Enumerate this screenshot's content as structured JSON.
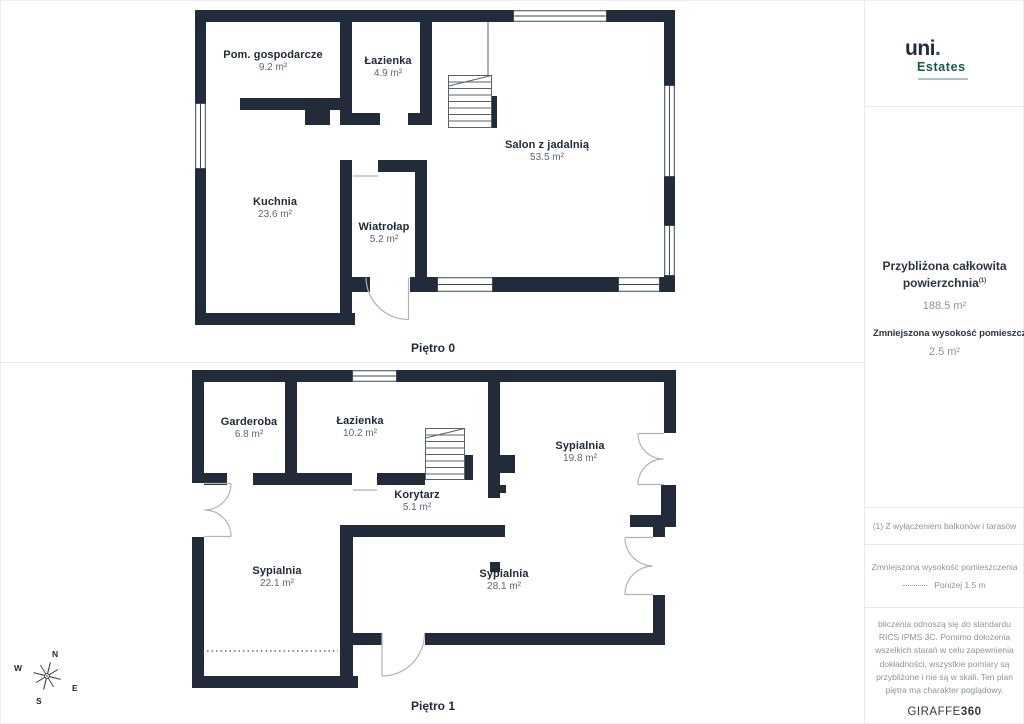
{
  "brand_logo": {
    "name": "uni",
    "dot": ".",
    "subtitle": "Estates"
  },
  "sidebar": {
    "total_area_label": "Przybliżona całkowita powierzchnia",
    "total_area_sup": "(1)",
    "total_area_value": "188.5 m²",
    "reduced_height_label": "Zmniejszona wysokość pomieszczenia",
    "reduced_height_value": "2.5 m²",
    "footnote": "(1) Z wyłączeniem balkonów i tarasów",
    "legend_title": "Zmniejszona wysokość pomieszczenia",
    "legend_item": "Poniżej 1.5 m",
    "disclaimer": "bliczenia odnoszą się do standardu RICS IPMS 3C. Pomimo dołożenia wszelkich starań w celu zapewnienia dokładności, wszystkie pomiary są przybliżone i nie są w skali. Ten plan piętra ma charakter poglądowy.",
    "watermark_regular": "GIRAFFE",
    "watermark_bold": "360"
  },
  "floors": [
    {
      "caption": "Piętro 0",
      "rooms": [
        {
          "name": "Pom. gospodarcze",
          "area": "9.2 m²"
        },
        {
          "name": "Łazienka",
          "area": "4.9 m²"
        },
        {
          "name": "Salon z jadalnią",
          "area": "53.5 m²"
        },
        {
          "name": "Kuchnia",
          "area": "23.6 m²"
        },
        {
          "name": "Wiatrołap",
          "area": "5.2 m²"
        }
      ]
    },
    {
      "caption": "Piętro 1",
      "rooms": [
        {
          "name": "Garderoba",
          "area": "6.8 m²"
        },
        {
          "name": "Łazienka",
          "area": "10.2 m²"
        },
        {
          "name": "Sypialnia",
          "area": "19.8 m²"
        },
        {
          "name": "Korytarz",
          "area": "5.1 m²"
        },
        {
          "name": "Sypialnia",
          "area": "22.1 m²"
        },
        {
          "name": "Sypialnia",
          "area": "28.1 m²"
        }
      ]
    }
  ],
  "compass": {
    "north": "N",
    "south": "S",
    "east": "E",
    "west": "W"
  },
  "colors": {
    "wall": "#212b3a",
    "accent_green": "#15594a"
  }
}
